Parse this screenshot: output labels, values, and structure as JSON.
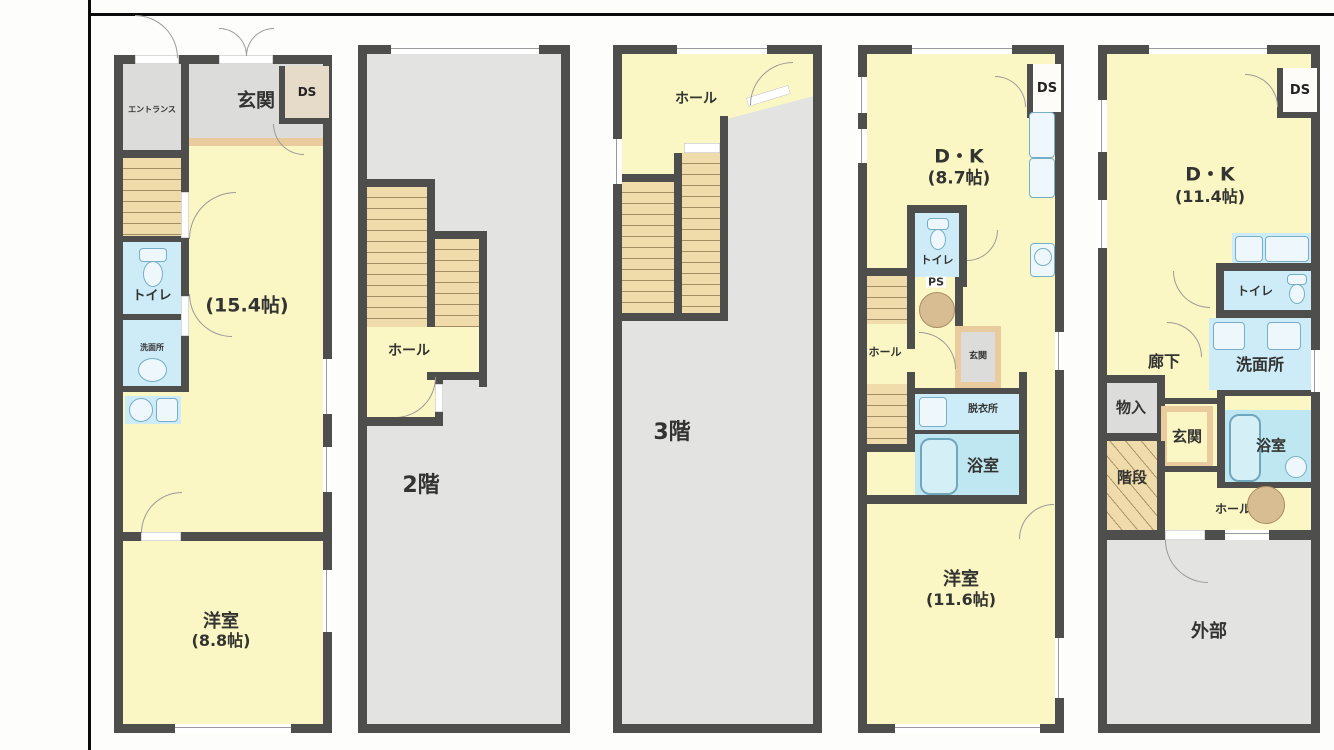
{
  "colors": {
    "wall": "#4e4e4c",
    "room_yellow": "#fbf7c4",
    "room_gray": "#dcdcda",
    "floor_gray": "#e3e3e1",
    "wet_blue": "#cdecf7",
    "stairs_tan": "#f0dcab",
    "threshold_tan": "#e9cb9e",
    "pillar_tan": "#d8bd92"
  },
  "panels": [
    {
      "id": "plan-1",
      "rooms": {
        "entrance_lobby": "エントランス",
        "genkan": "玄関",
        "ds": "DS",
        "main_size": "(15.4帖)",
        "toilet": "トイレ",
        "washroom": "洗面所",
        "bedroom": "洋室",
        "bedroom_size": "(8.8帖)"
      }
    },
    {
      "id": "plan-2",
      "rooms": {
        "hall": "ホール",
        "floor": "2階"
      }
    },
    {
      "id": "plan-3",
      "rooms": {
        "hall": "ホール",
        "floor": "3階"
      }
    },
    {
      "id": "plan-4",
      "rooms": {
        "dk": "D・K",
        "dk_size": "(8.7帖)",
        "ds": "DS",
        "toilet": "トイレ",
        "ps": "PS",
        "hall": "ホール",
        "genkan": "玄関",
        "dressing": "脱衣所",
        "bath": "浴室",
        "bedroom": "洋室",
        "bedroom_size": "(11.6帖)"
      }
    },
    {
      "id": "plan-5",
      "rooms": {
        "dk": "D・K",
        "dk_size": "(11.4帖)",
        "ds": "DS",
        "toilet": "トイレ",
        "corridor": "廊下",
        "washroom": "洗面所",
        "storage": "物入",
        "genkan": "玄関",
        "bath": "浴室",
        "staircase": "階段",
        "hall": "ホール",
        "exterior": "外部"
      }
    }
  ]
}
